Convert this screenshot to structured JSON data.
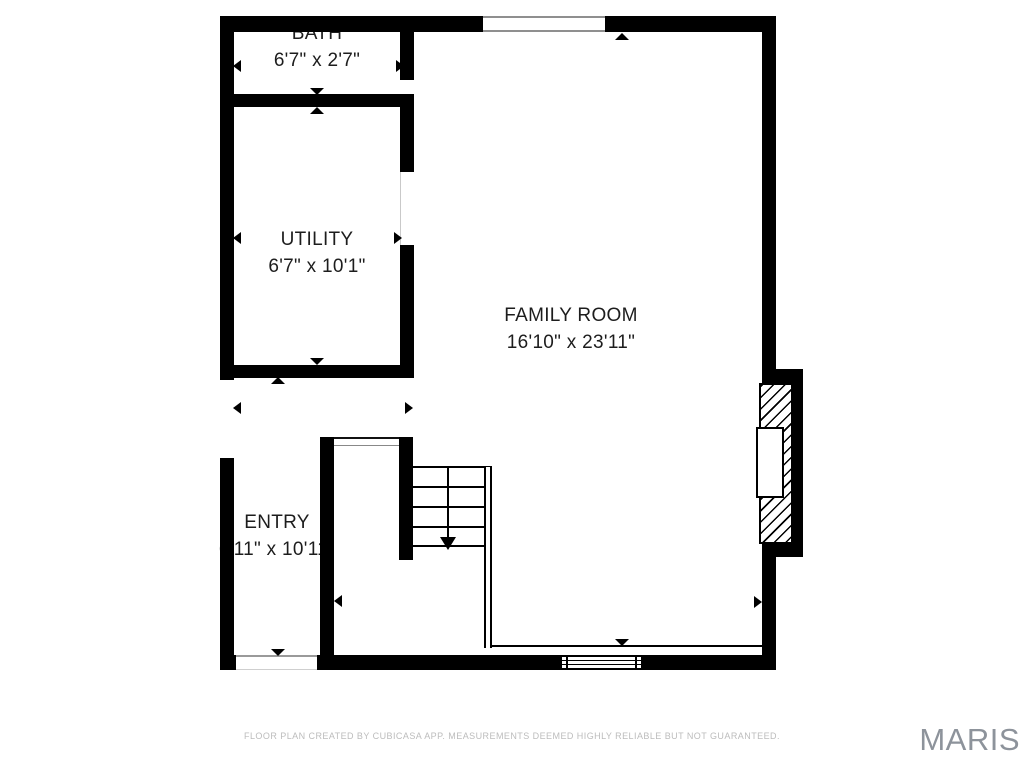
{
  "plan": {
    "type": "floor-plan",
    "rooms": [
      {
        "id": "bath",
        "label": "BATH",
        "dims": "6'7\" x 2'7\""
      },
      {
        "id": "utility",
        "label": "UTILITY",
        "dims": "6'7\" x 10'1\""
      },
      {
        "id": "family_room",
        "label": "FAMILY ROOM",
        "dims": "16'10\" x 23'11\""
      },
      {
        "id": "entry",
        "label": "ENTRY",
        "dims": "6'11\" x 10'11\""
      }
    ],
    "features": [
      "staircase-down",
      "fireplace",
      "window",
      "door-openings",
      "dimension-arrows"
    ]
  },
  "footer": {
    "disclaimer": "FLOOR PLAN CREATED BY CUBICASA APP. MEASUREMENTS DEEMED HIGHLY RELIABLE BUT NOT GUARANTEED."
  },
  "watermark": {
    "text": "MARIS"
  },
  "colors": {
    "wall": "#000000",
    "room_label": "#1d1d1d",
    "disclaimer": "#bcbcbc",
    "watermark": "#8d939b",
    "background": "#ffffff"
  }
}
